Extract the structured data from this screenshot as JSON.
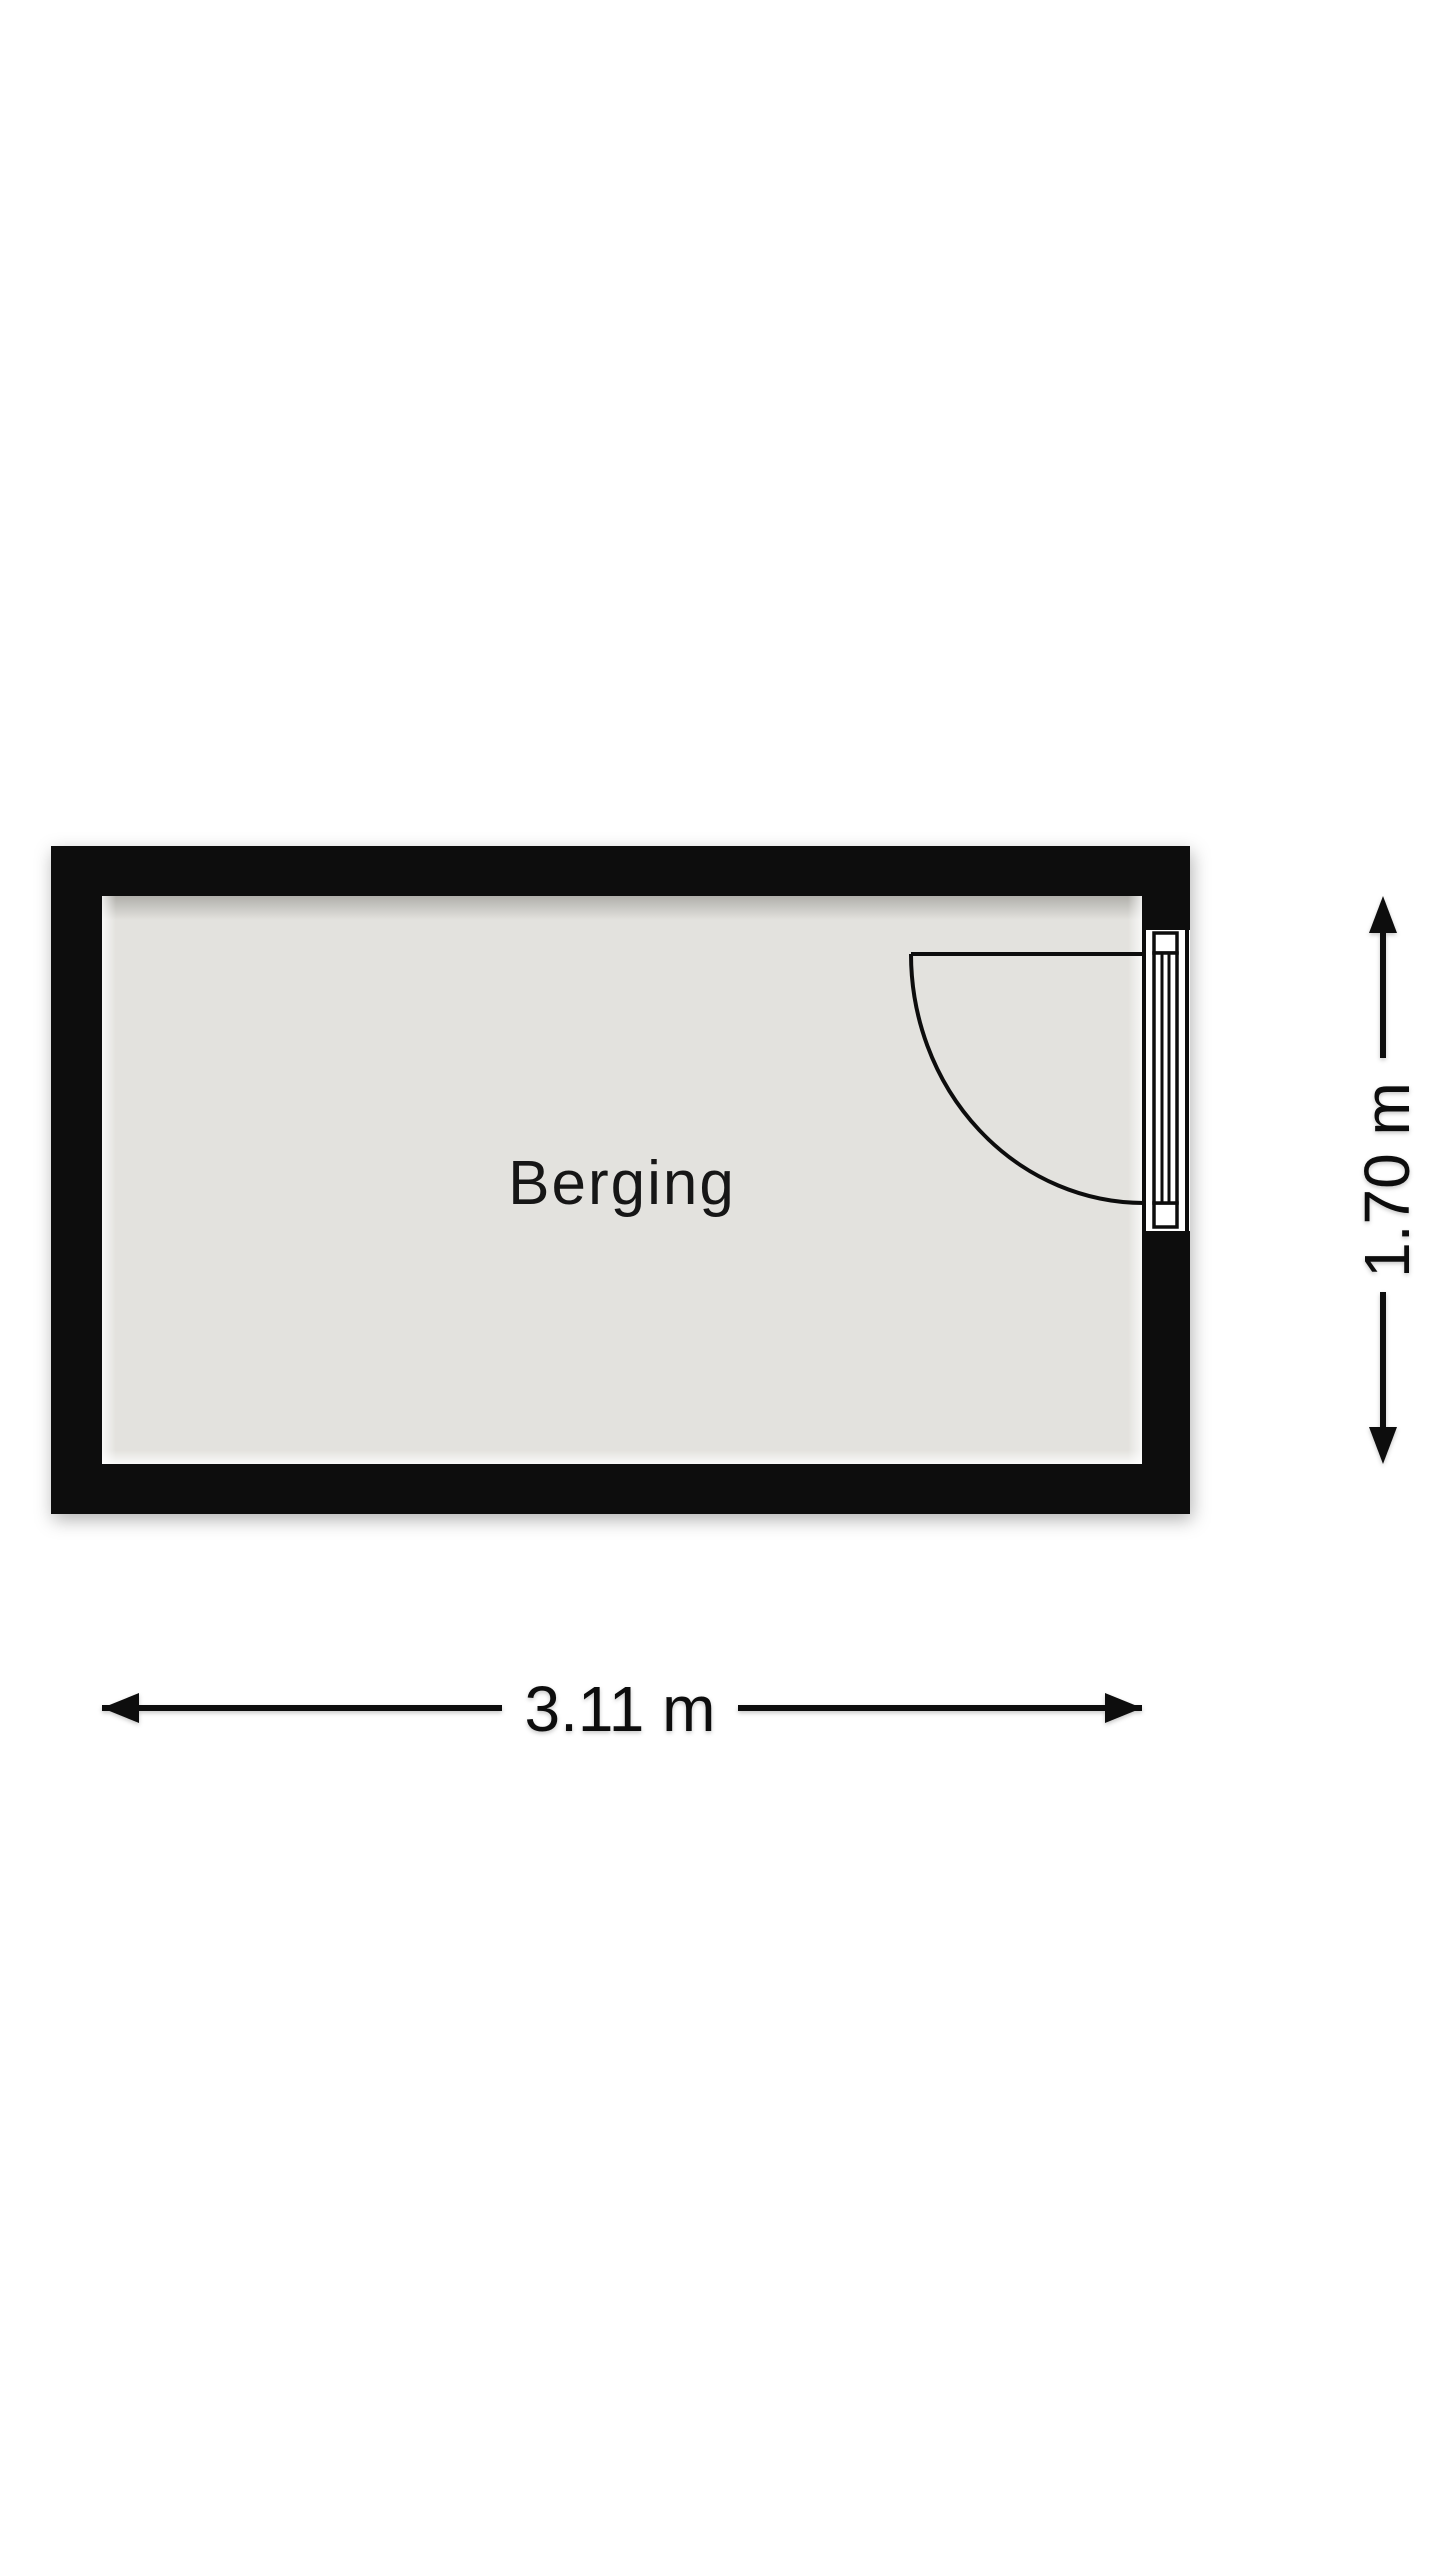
{
  "floorplan": {
    "room": {
      "label": "Berging"
    },
    "dimensions": {
      "width": {
        "label": "3.11 m",
        "value_m": 3.11
      },
      "height": {
        "label": "1.70 m",
        "value_m": 1.7
      }
    },
    "door": {
      "description": "single swing door in right wall, opening inward toward top wall"
    },
    "colors": {
      "wall": "#0b0b0b",
      "floor": "#e3e2de",
      "door_opening": "#ffffff",
      "ink": "#111111",
      "background": "#ffffff"
    }
  }
}
